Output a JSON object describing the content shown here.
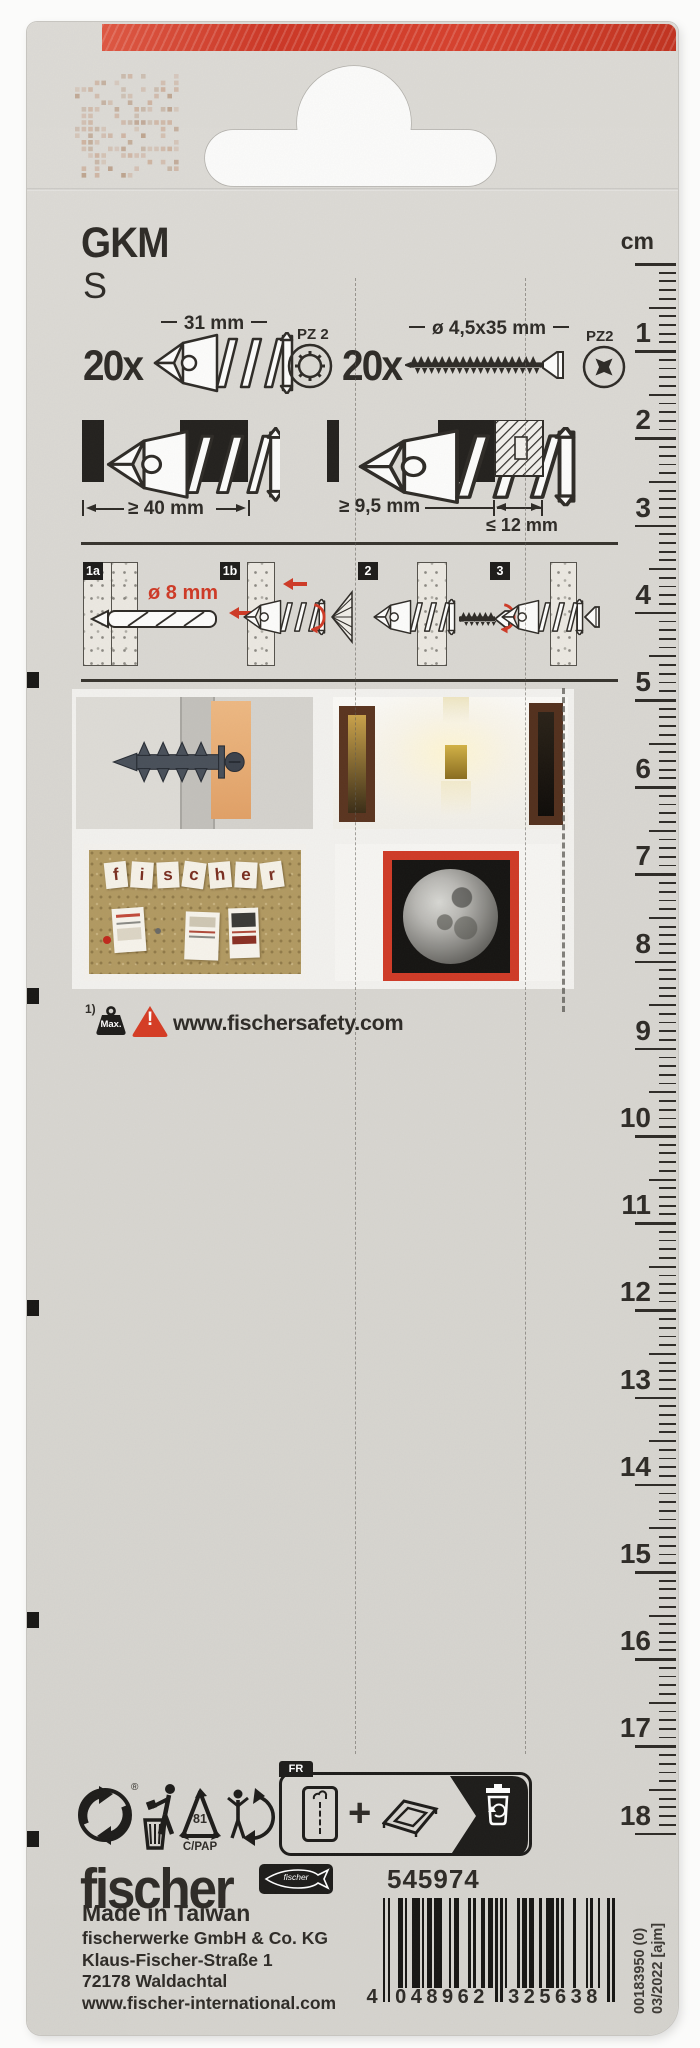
{
  "card": {
    "title": "GKM",
    "variant": "S",
    "contents": [
      {
        "qty": "20x",
        "size_label": "31 mm",
        "drive": "PZ 2"
      },
      {
        "qty": "20x",
        "size_label": "ø 4,5x35 mm",
        "drive": "PZ2"
      }
    ],
    "install_dims": {
      "wall_depth": "≥ 40 mm",
      "cavity": "≥ 9,5 mm",
      "board_max": "≤ 12 mm"
    },
    "steps": [
      {
        "label": "1a",
        "note": "ø 8 mm"
      },
      {
        "label": "1b"
      },
      {
        "label": "2"
      },
      {
        "label": "3"
      }
    ],
    "photos": {
      "corkboard_word": "fischer"
    },
    "safety": {
      "footnote": "1)",
      "weight_label": "Max.",
      "warning_glyph": "!",
      "url": "www.fischersafety.com"
    },
    "recycling": {
      "material_code": "81",
      "material": "C/PAP",
      "country_tab": "FR"
    },
    "symbols": {
      "registered": "®",
      "plus": "+"
    },
    "brand": {
      "logo": "fischer",
      "emblem_word": "fischer"
    },
    "origin": "Made in Taiwan",
    "article_number": "545974",
    "address": [
      "fischerwerke GmbH & Co. KG",
      "Klaus-Fischer-Straße 1",
      "72178 Waldachtal",
      "www.fischer-international.com"
    ],
    "barcode": {
      "value": "4048962325638",
      "human": [
        "4",
        "048962",
        "325638"
      ]
    },
    "print_refs": [
      "00183950 (0)",
      "03/2022 [ajm]"
    ]
  },
  "ruler": {
    "unit": "cm",
    "start": 1,
    "end": 18
  }
}
